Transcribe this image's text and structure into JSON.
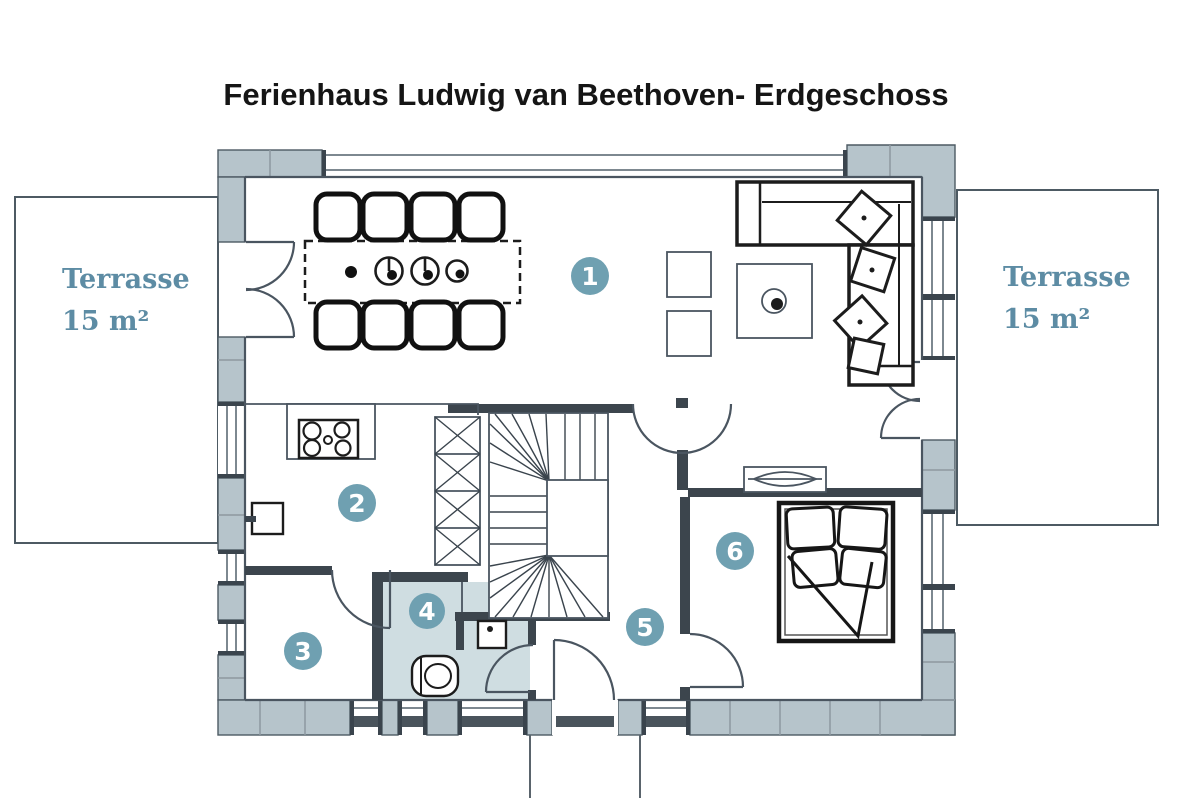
{
  "title": "Ferienhaus Ludwig van Beethoven- Erdgeschoss",
  "terrace_left": {
    "label": "Terrasse",
    "area": "15 m²"
  },
  "terrace_right": {
    "label": "Terrasse",
    "area": "15 m²"
  },
  "rooms": [
    {
      "number": "1"
    },
    {
      "number": "2"
    },
    {
      "number": "3"
    },
    {
      "number": "4"
    },
    {
      "number": "5"
    },
    {
      "number": "6"
    }
  ],
  "colors": {
    "badge": "#6fa0b1",
    "badge_text": "#ffffff",
    "terrace_text": "#5d8ca4",
    "wall": "#b6c4cb",
    "line": "#4d5a63",
    "bath_floor": "#cfdde1"
  }
}
